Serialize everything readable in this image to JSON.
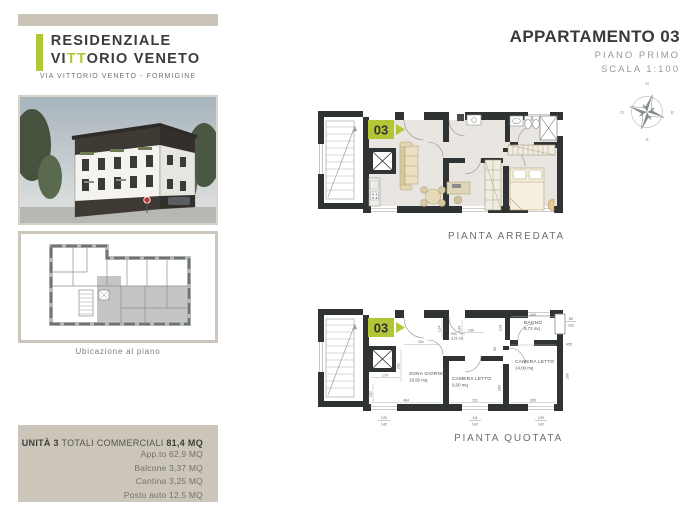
{
  "logo": {
    "line1": "RESIDENZIALE",
    "line2_pre": "VI",
    "line2_accent": "TT",
    "line2_post": "ORIO VENETO",
    "address": "VIA VITTORIO VENETO - FORMIGINE"
  },
  "header": {
    "title": "APPARTAMENTO 03",
    "floor": "PIANO PRIMO",
    "scale": "SCALA 1:100"
  },
  "compass": {
    "n": "N",
    "o": "O",
    "s": "S",
    "e": "E"
  },
  "ubicazione": {
    "caption": "Ubicazione al piano"
  },
  "plans": {
    "arredata": {
      "label": "PIANTA ARREDATA",
      "badge": "03"
    },
    "quotata": {
      "label": "PIANTA QUOTATA",
      "badge": "03",
      "rooms": {
        "zona": {
          "name": "ZONA GIORNO",
          "area": "18,56 mq"
        },
        "cam9": {
          "name": "CAMERA LETTO",
          "area": "9,00 mq"
        },
        "cam14": {
          "name": "CAMERA LETTO",
          "area": "14,00 mq"
        },
        "bagno": {
          "name": "BAGNO",
          "area": "5,73 mq"
        },
        "dis": {
          "name": "DIS.",
          "area": "3,21 mq"
        }
      },
      "dims": {
        "d281": "281",
        "d261": "261",
        "d170": "170",
        "d197": "197",
        "d464": "464",
        "d150": "150",
        "d124": "124",
        "d134a": "134",
        "d134b": "134",
        "d443": "443",
        "d455": "455",
        "d99": "99",
        "d289": "289",
        "d311": "311",
        "d305": "305",
        "d260": "260",
        "win_right_a": "80",
        "win_right_b": "162",
        "win1a": "120",
        "win1b": "142",
        "win2a": "111",
        "win2b": "142",
        "win3a": "120",
        "win3b": "142"
      }
    }
  },
  "info_box": {
    "unit": "UNITÀ 3",
    "mid": " TOTALI COMMERCIALI ",
    "total": "81,4 MQ",
    "items": [
      "App.to 62,9 MQ",
      "Balcone 3,37 MQ",
      "Cantina 3,25 MQ",
      "Posto auto 12,5 MQ"
    ]
  },
  "colors": {
    "accent_green": "#b2c636",
    "wall": "#2f3334",
    "taupe": "#cbc5ba",
    "floor": "#e9e6e2"
  }
}
